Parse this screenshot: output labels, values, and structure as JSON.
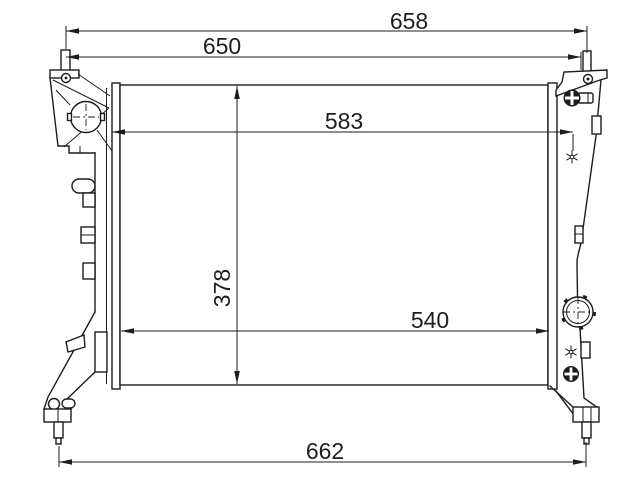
{
  "drawing": {
    "kind": "technical-dimension-drawing",
    "subject": "radiator-front-view",
    "background_color": "#ffffff",
    "line_color": "#1d1d1d",
    "dimensions": {
      "top_outer_width": "658",
      "top_inner_width": "650",
      "upper_core_width": "583",
      "core_height": "378",
      "lower_core_width": "540",
      "bottom_overall_width": "662"
    }
  }
}
